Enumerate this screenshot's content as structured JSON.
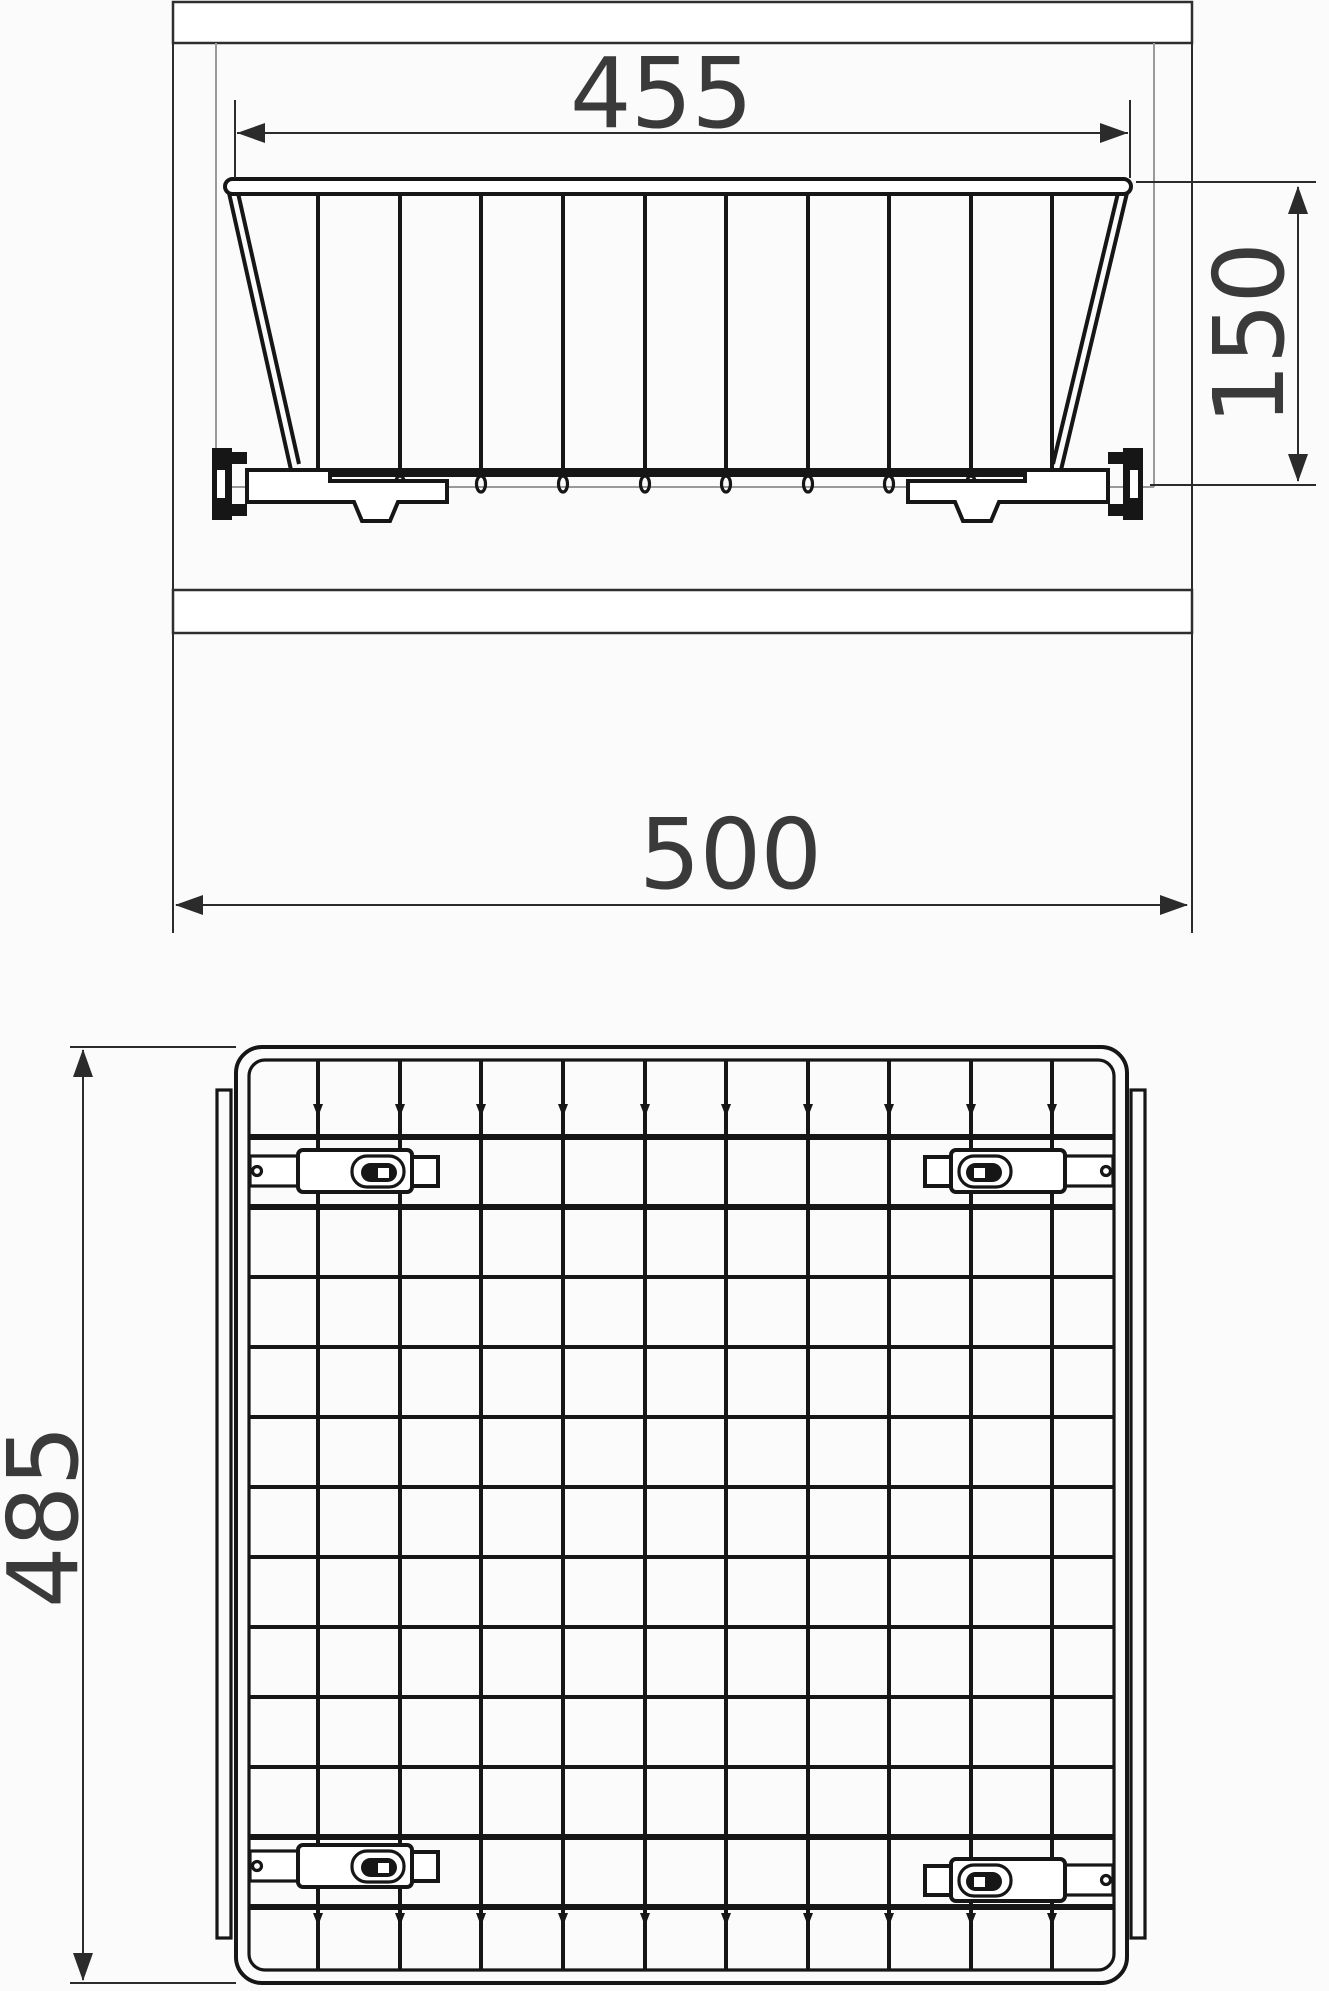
{
  "drawing": {
    "type": "technical-dimension-drawing",
    "subject": "pull-out wire storage basket mounted between cabinet side panels",
    "views": {
      "front_elevation": "basket front view inside cabinet carcass",
      "top_plan": "basket grid seen from above with four mounting clips"
    },
    "dimensions": {
      "top_width": "455",
      "height": "150",
      "overall_width": "500",
      "depth": "485"
    },
    "colors": {
      "line": "#161616",
      "dim_line": "#2b2b2b",
      "text": "#3a3a3a",
      "light_line": "#9a9a9a",
      "background": "#fbfbfb"
    }
  }
}
